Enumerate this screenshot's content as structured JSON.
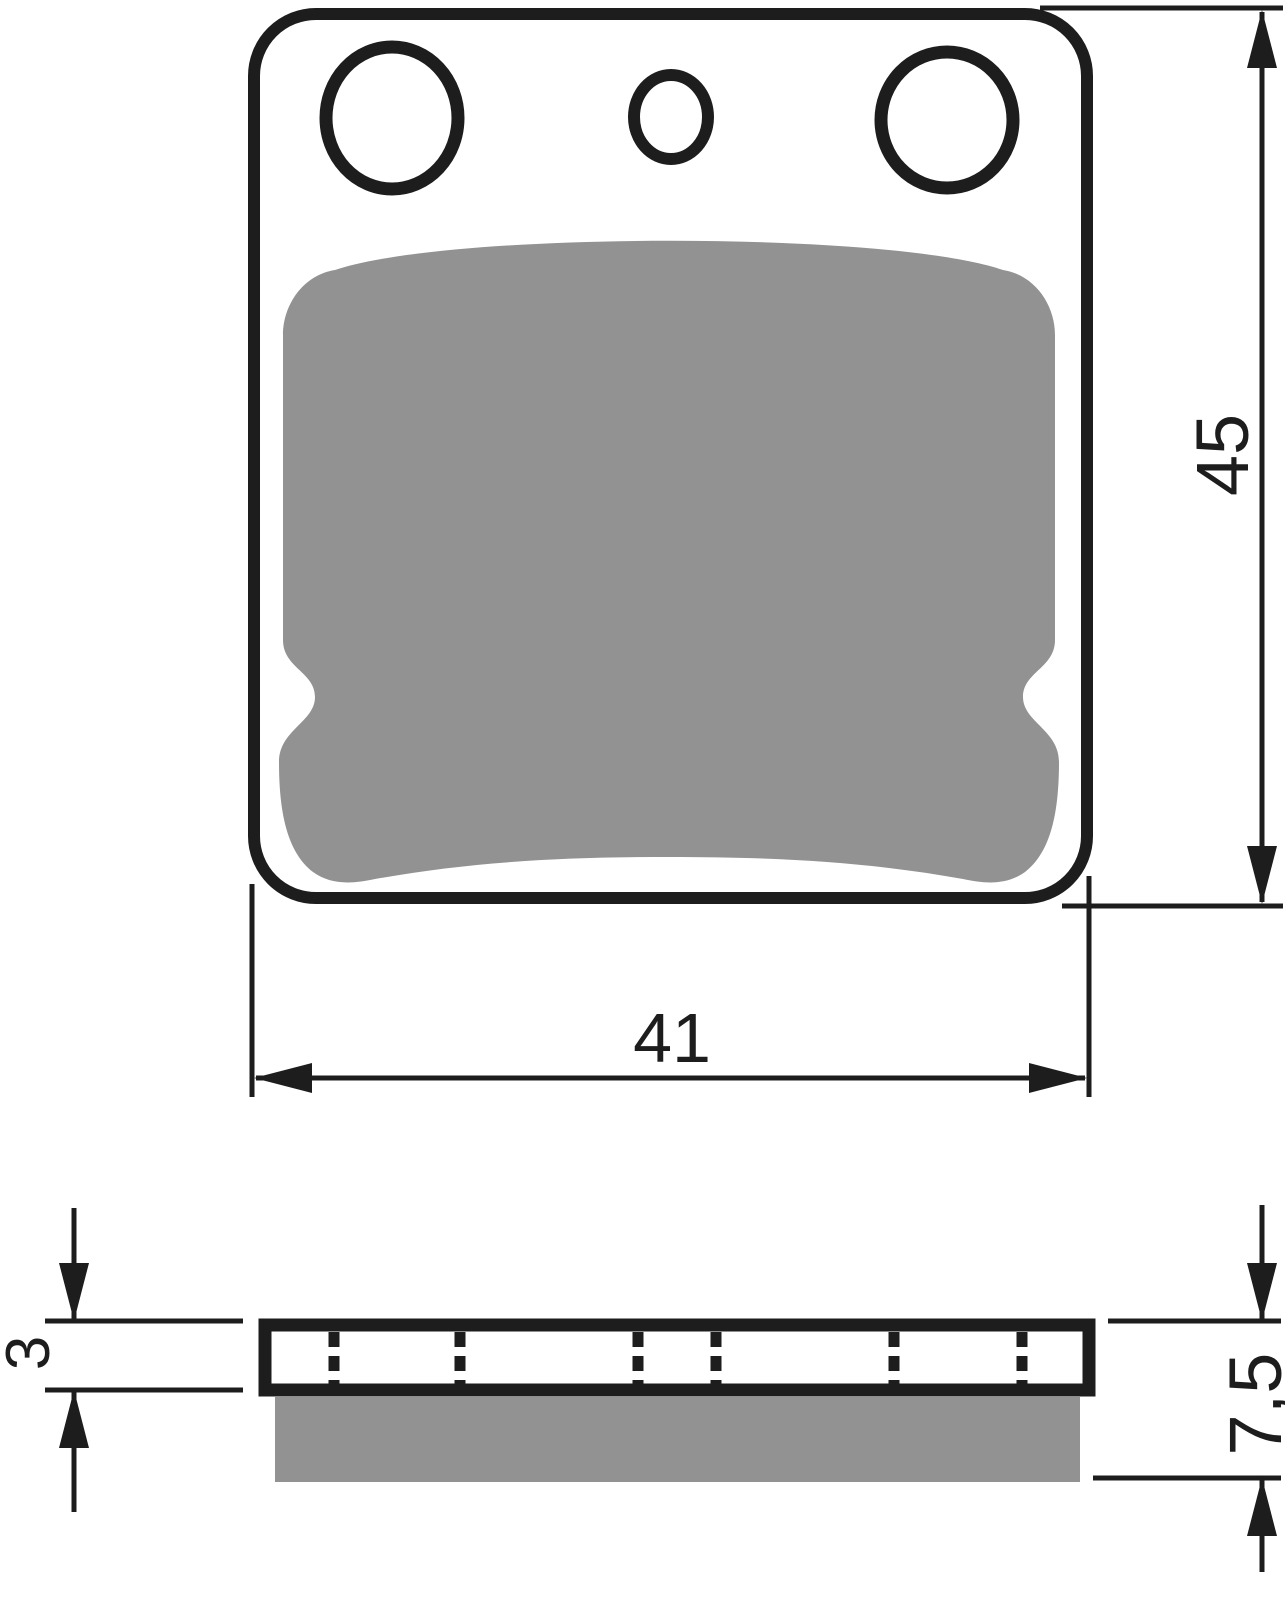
{
  "drawing": {
    "type": "technical-drawing",
    "subject": "brake pad — front view and side profile",
    "front_view": {
      "width_dimension": "41",
      "height_dimension": "45",
      "holes": [
        {
          "name": "left-mounting-hole",
          "size": "large"
        },
        {
          "name": "center-hole",
          "size": "small"
        },
        {
          "name": "right-mounting-hole",
          "size": "large"
        }
      ]
    },
    "side_view": {
      "backplate_thickness_dimension": "3",
      "total_thickness_dimension": "7,5",
      "hidden_edge_lines": 6
    },
    "colors": {
      "line": "#1d1d1d",
      "friction_material_fill": "#929292",
      "background": "#ffffff"
    }
  }
}
